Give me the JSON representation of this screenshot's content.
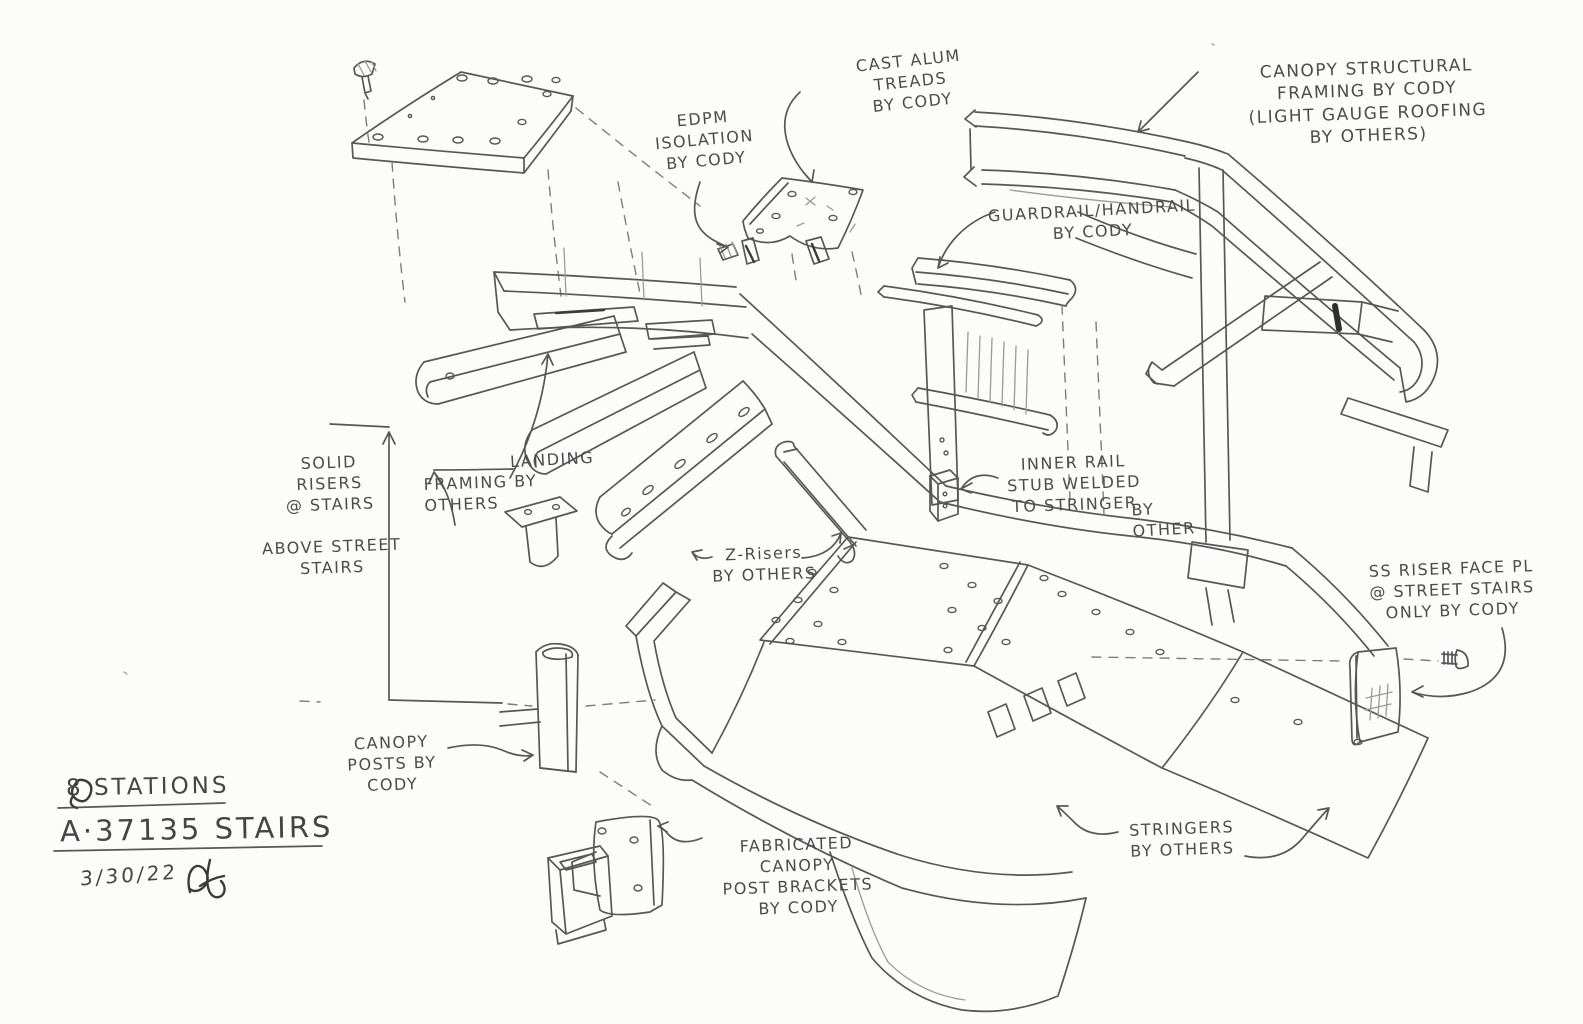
{
  "sketch": {
    "title_block": {
      "stations_line": "8 STATIONS",
      "project_line": "A·37135 STAIRS",
      "date": "3/30/22",
      "signature_initials": "AJ"
    },
    "annotations": {
      "cast_alum_treads": "CAST ALUM\nTREADS\nBY CODY",
      "edpm_isolation": "EDPM\nISOLATION\nBY CODY",
      "canopy_structural_framing": "CANOPY STRUCTURAL\nFRAMING BY CODY\n(LIGHT GAUGE ROOFING\nBY OTHERS)",
      "guardrail_handrail": "GUARDRAIL/HANDRAIL\nBY CODY",
      "solid_risers": "SOLID\nRISERS\n@ STAIRS",
      "above_street_stairs": "ABOVE STREET\nSTAIRS",
      "landing": "LANDING",
      "framing_by_others": "FRAMING BY\nOTHERS",
      "z_risers": "Z-Risers\nBY OTHERS",
      "inner_rail_stub": "INNER RAIL\nSTUB WELDED\nTO STRINGER",
      "inner_rail_stub_by_other": "BY\nOTHER",
      "ss_riser_face": "SS RISER FACE PL\n@ STREET STAIRS\nONLY BY CODY",
      "canopy_posts": "CANOPY\nPOSTS BY\nCODY",
      "fabricated_brackets": "FABRICATED\nCANOPY\nPOST BRACKETS\nBY CODY",
      "stringers_by_others": "STRINGERS\nBY OTHERS"
    },
    "colors": {
      "paper": "#fcfcfa",
      "ink": "#575757",
      "ink_dark": "#3b3b3b",
      "ink_light": "#9a9a9a"
    }
  }
}
